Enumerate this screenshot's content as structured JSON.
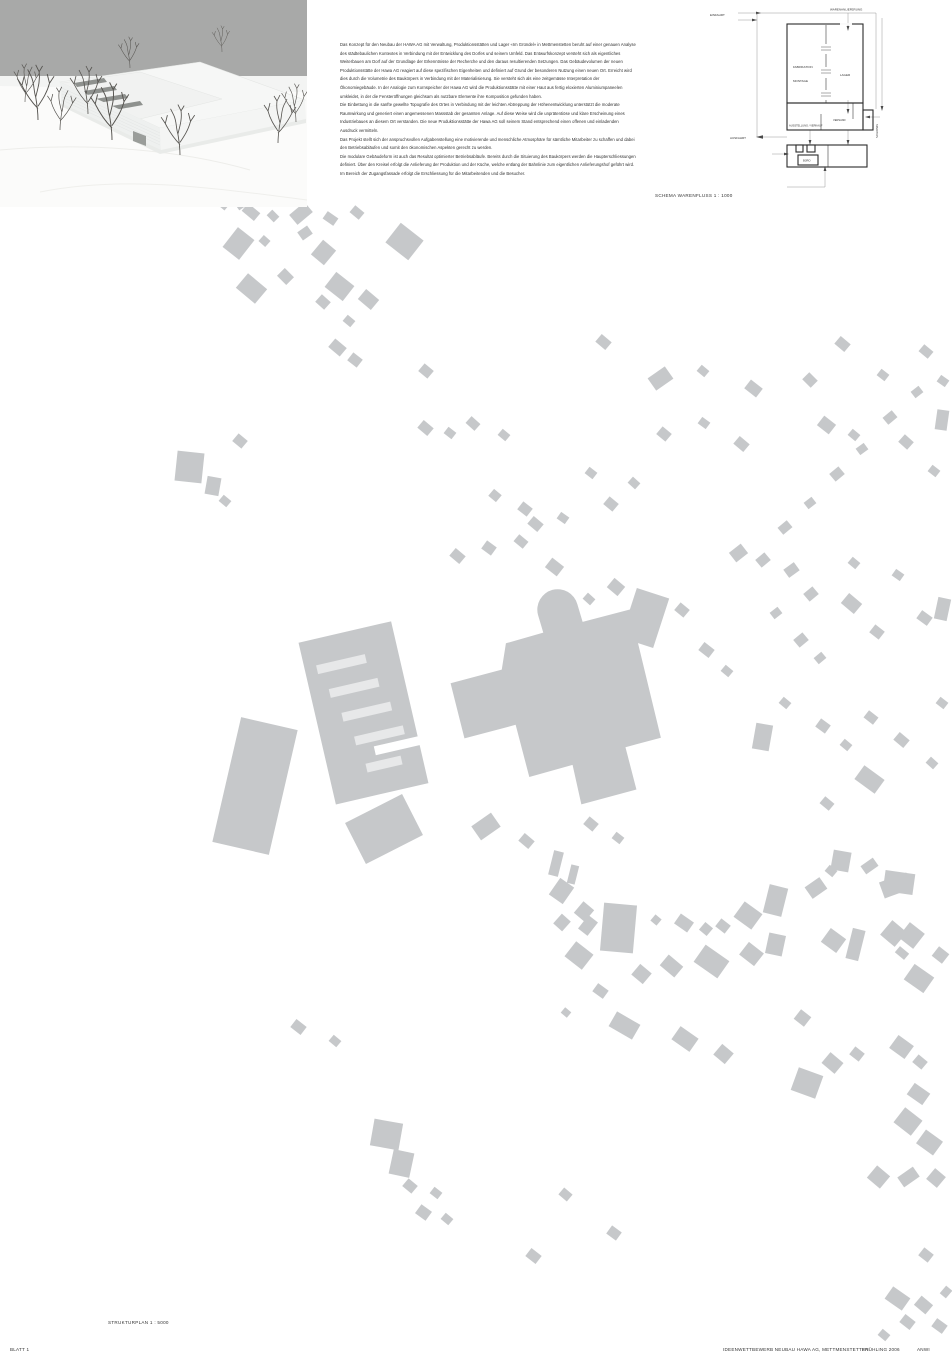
{
  "description": {
    "paragraphs": [
      "Das Konzept für den Neubau der HAWA AG mit Verwaltung, Produktionsstätten und Lager «Im Gründel» in Mettmenstetten beruht auf einer genauen Analyse des städtebaulichen Kontextes in Verbindung mit der Entwicklung des Dorfes und seinem Umfeld. Das Entwurfskonzept versteht sich als eigentliches Weiterbauen am Dorf auf der Grundlage der Erkenntnisse der Recherche und den daraus resultierenden Setzungen. Das Gebäudevolumen der neuen Produktionsstätte der Hawa AG reagiert auf diese spezifischen Eigenheiten und definiert auf Grund der besonderen Nutzung einen neuen Ort. Erreicht wird dies durch die Volumetrie des Baukörpers in Verbindung mit der Materialisierung. Sie versteht sich als eine zeitgemässe Interpretation der Ökonomiegebäude. In der Analogie zum Kornspeicher der Hawa AG wird die Produktionsstätte mit einer Haut aus fertig eloxierten Aluminiumpaneelen umkleidet, in der die Fensteröffnungen gleichsam als nutzbare Elemente ihre Komposition gefunden haben.",
      "Die Einbettung in die sanfte gewellte Topografie des Ortes in Verbindung mit der leichten Abtreppung der Höhenentwicklung unterstützt die moderate Raumwirkung und generiert einen angemessenen Massstab der gesamten Anlage. Auf diese Weise wird die unprätentiöse und klare Erscheinung eines Industriebaues an diesem Ort verstanden. Die neue Produktionsstätte der Hawa AG soll seinem Stand entsprechend einen offenen und einladenden Ausdruck vermitteln.",
      "Das Projekt stellt sich der anspruchsvollen Aufgabenstellung eine motivierende und menschliche Atmosphäre für sämtliche Mitarbeiter zu schaffen und dabei den Betriebsabläufen und somit den ökonomischen Aspekten gerecht zu werden.",
      "Die modulare Gebäudeform ist auch das Resultat optimierter Betriebsabläufe. Bereits durch die Situierung des Baukörpers werden die Haupterschliessungen definiert. Über den Kreisel erfolgt die Anlieferung der Produktion und der Küche, welche entlang der Bahnlinie zum eigentlichen Anlieferungshof geführt wird. Im Bereich der Zugangsfassade erfolgt die Erschliessung für die Mitarbeitenden und die Besucher."
    ]
  },
  "schema": {
    "caption": "SCHEMA WARENFLUSS    1 : 1000",
    "labels": {
      "einfahrt": "EINFAHRT",
      "warenanlieferung": "WARENANLIEFERUNG",
      "fabrikation": "FABRIKATION",
      "montage": "MONTAGE",
      "lager": "LAGER",
      "ausstellung": "AUSSTELLUNG / VERKAUF",
      "versand": "VERSAND",
      "spedition": "SPEDITION",
      "ausfahrt": "AUSFAHRT",
      "buero": "BÜRO"
    }
  },
  "site_plan": {
    "caption": "STRUKTURPLAN   1 : 5000",
    "building_color": "#c6c8ca",
    "buildings": [
      [
        215,
        198,
        14,
        9,
        40
      ],
      [
        236,
        200,
        11,
        8,
        -35
      ],
      [
        243,
        207,
        16,
        10,
        40
      ],
      [
        268,
        212,
        10,
        8,
        45
      ],
      [
        291,
        207,
        20,
        13,
        -40
      ],
      [
        324,
        214,
        13,
        9,
        35
      ],
      [
        351,
        208,
        12,
        9,
        40
      ],
      [
        228,
        231,
        21,
        25,
        38
      ],
      [
        260,
        237,
        9,
        8,
        42
      ],
      [
        299,
        228,
        12,
        10,
        -35
      ],
      [
        315,
        243,
        17,
        19,
        40
      ],
      [
        390,
        229,
        29,
        25,
        38
      ],
      [
        239,
        279,
        25,
        19,
        40
      ],
      [
        279,
        271,
        13,
        11,
        45
      ],
      [
        328,
        277,
        23,
        19,
        38
      ],
      [
        317,
        297,
        12,
        10,
        42
      ],
      [
        360,
        293,
        17,
        13,
        40
      ],
      [
        344,
        317,
        10,
        8,
        40
      ],
      [
        330,
        342,
        15,
        11,
        40
      ],
      [
        349,
        355,
        12,
        10,
        38
      ],
      [
        420,
        366,
        12,
        10,
        40
      ],
      [
        597,
        337,
        13,
        10,
        40
      ],
      [
        650,
        371,
        21,
        15,
        -35
      ],
      [
        698,
        367,
        10,
        8,
        40
      ],
      [
        746,
        383,
        15,
        11,
        38
      ],
      [
        804,
        375,
        12,
        10,
        45
      ],
      [
        836,
        339,
        13,
        10,
        40
      ],
      [
        878,
        371,
        10,
        8,
        38
      ],
      [
        920,
        347,
        12,
        9,
        40
      ],
      [
        938,
        377,
        10,
        8,
        35
      ],
      [
        936,
        410,
        12,
        20,
        8
      ],
      [
        176,
        452,
        27,
        30,
        6
      ],
      [
        206,
        477,
        14,
        18,
        10
      ],
      [
        234,
        436,
        12,
        10,
        40
      ],
      [
        220,
        497,
        10,
        8,
        40
      ],
      [
        419,
        423,
        13,
        10,
        40
      ],
      [
        445,
        429,
        10,
        8,
        38
      ],
      [
        467,
        419,
        12,
        9,
        42
      ],
      [
        499,
        431,
        10,
        8,
        40
      ],
      [
        490,
        491,
        10,
        9,
        40
      ],
      [
        519,
        504,
        12,
        10,
        38
      ],
      [
        529,
        519,
        13,
        10,
        40
      ],
      [
        558,
        514,
        10,
        8,
        35
      ],
      [
        586,
        469,
        10,
        8,
        38
      ],
      [
        605,
        499,
        12,
        10,
        40
      ],
      [
        629,
        479,
        10,
        8,
        42
      ],
      [
        658,
        429,
        12,
        10,
        40
      ],
      [
        699,
        419,
        10,
        8,
        36
      ],
      [
        735,
        439,
        13,
        10,
        40
      ],
      [
        819,
        419,
        15,
        12,
        38
      ],
      [
        849,
        431,
        10,
        8,
        40
      ],
      [
        900,
        437,
        12,
        10,
        42
      ],
      [
        929,
        467,
        10,
        8,
        38
      ],
      [
        912,
        388,
        10,
        8,
        -38
      ],
      [
        884,
        413,
        12,
        9,
        -40
      ],
      [
        857,
        445,
        10,
        8,
        -36
      ],
      [
        831,
        469,
        12,
        10,
        -40
      ],
      [
        805,
        499,
        10,
        8,
        -38
      ],
      [
        779,
        523,
        12,
        9,
        -40
      ],
      [
        451,
        551,
        13,
        10,
        40
      ],
      [
        483,
        543,
        12,
        10,
        36
      ],
      [
        515,
        537,
        12,
        9,
        40
      ],
      [
        547,
        561,
        15,
        12,
        38
      ],
      [
        584,
        595,
        10,
        8,
        42
      ],
      [
        609,
        581,
        14,
        12,
        40
      ],
      [
        628,
        592,
        34,
        52,
        18
      ],
      [
        676,
        605,
        12,
        10,
        40
      ],
      [
        700,
        645,
        13,
        10,
        38
      ],
      [
        722,
        667,
        10,
        8,
        40
      ],
      [
        731,
        547,
        15,
        12,
        -38
      ],
      [
        757,
        555,
        12,
        10,
        -40
      ],
      [
        785,
        565,
        13,
        10,
        -36
      ],
      [
        805,
        589,
        12,
        10,
        -40
      ],
      [
        771,
        609,
        10,
        8,
        -38
      ],
      [
        795,
        635,
        12,
        10,
        -40
      ],
      [
        815,
        654,
        10,
        8,
        -40
      ],
      [
        843,
        597,
        17,
        13,
        40
      ],
      [
        871,
        627,
        12,
        10,
        38
      ],
      [
        918,
        613,
        13,
        10,
        36
      ],
      [
        849,
        559,
        10,
        8,
        40
      ],
      [
        893,
        571,
        10,
        8,
        35
      ],
      [
        936,
        598,
        13,
        22,
        12
      ],
      [
        226,
        722,
        58,
        128,
        13
      ],
      [
        352,
        806,
        64,
        46,
        -27
      ],
      [
        754,
        724,
        17,
        26,
        10
      ],
      [
        780,
        699,
        10,
        8,
        40
      ],
      [
        817,
        721,
        12,
        10,
        36
      ],
      [
        841,
        741,
        10,
        8,
        40
      ],
      [
        865,
        713,
        12,
        9,
        38
      ],
      [
        895,
        735,
        13,
        10,
        40
      ],
      [
        927,
        759,
        10,
        8,
        42
      ],
      [
        937,
        699,
        10,
        8,
        38
      ],
      [
        857,
        771,
        25,
        17,
        36
      ],
      [
        821,
        799,
        12,
        9,
        40
      ],
      [
        884,
        872,
        30,
        21,
        8
      ],
      [
        474,
        818,
        24,
        17,
        -35
      ],
      [
        520,
        836,
        13,
        10,
        40
      ],
      [
        551,
        851,
        10,
        25,
        14
      ],
      [
        569,
        865,
        8,
        19,
        14
      ],
      [
        585,
        819,
        12,
        10,
        40
      ],
      [
        613,
        834,
        10,
        8,
        38
      ],
      [
        553,
        881,
        17,
        20,
        35
      ],
      [
        577,
        904,
        14,
        15,
        40
      ],
      [
        556,
        916,
        12,
        13,
        42
      ],
      [
        582,
        917,
        12,
        17,
        38
      ],
      [
        602,
        904,
        33,
        48,
        5
      ],
      [
        568,
        946,
        22,
        19,
        38
      ],
      [
        634,
        967,
        15,
        14,
        40
      ],
      [
        652,
        916,
        8,
        8,
        40
      ],
      [
        676,
        917,
        16,
        12,
        35
      ],
      [
        701,
        924,
        10,
        10,
        40
      ],
      [
        717,
        921,
        12,
        10,
        38
      ],
      [
        737,
        906,
        22,
        19,
        36
      ],
      [
        766,
        886,
        19,
        29,
        14
      ],
      [
        807,
        881,
        18,
        14,
        -35
      ],
      [
        832,
        851,
        18,
        20,
        10
      ],
      [
        862,
        861,
        15,
        10,
        -35
      ],
      [
        881,
        877,
        29,
        17,
        -20
      ],
      [
        826,
        867,
        10,
        8,
        40
      ],
      [
        697,
        951,
        29,
        21,
        35
      ],
      [
        742,
        946,
        19,
        16,
        38
      ],
      [
        767,
        934,
        17,
        21,
        12
      ],
      [
        824,
        932,
        19,
        17,
        36
      ],
      [
        849,
        929,
        13,
        31,
        14
      ],
      [
        884,
        924,
        19,
        19,
        40
      ],
      [
        902,
        926,
        19,
        19,
        38
      ],
      [
        907,
        969,
        24,
        19,
        35
      ],
      [
        896,
        949,
        12,
        8,
        40
      ],
      [
        934,
        949,
        13,
        12,
        38
      ],
      [
        662,
        959,
        19,
        14,
        40
      ],
      [
        594,
        986,
        13,
        10,
        36
      ],
      [
        562,
        1009,
        8,
        7,
        40
      ],
      [
        611,
        1017,
        27,
        17,
        30
      ],
      [
        674,
        1031,
        22,
        16,
        35
      ],
      [
        716,
        1047,
        15,
        14,
        40
      ],
      [
        796,
        1012,
        13,
        12,
        38
      ],
      [
        824,
        1056,
        17,
        14,
        40
      ],
      [
        851,
        1049,
        12,
        10,
        38
      ],
      [
        892,
        1039,
        19,
        16,
        36
      ],
      [
        914,
        1057,
        12,
        10,
        40
      ],
      [
        794,
        1071,
        26,
        24,
        20
      ],
      [
        909,
        1087,
        19,
        14,
        35
      ],
      [
        897,
        1112,
        22,
        19,
        38
      ],
      [
        919,
        1134,
        21,
        17,
        36
      ],
      [
        870,
        1169,
        17,
        16,
        40
      ],
      [
        899,
        1171,
        19,
        12,
        -35
      ],
      [
        929,
        1171,
        14,
        14,
        40
      ],
      [
        292,
        1022,
        13,
        10,
        38
      ],
      [
        330,
        1037,
        10,
        8,
        40
      ],
      [
        372,
        1121,
        29,
        27,
        10
      ],
      [
        391,
        1151,
        21,
        25,
        12
      ],
      [
        404,
        1181,
        12,
        10,
        40
      ],
      [
        431,
        1189,
        10,
        8,
        38
      ],
      [
        417,
        1207,
        13,
        11,
        36
      ],
      [
        442,
        1215,
        10,
        8,
        40
      ],
      [
        527,
        1251,
        13,
        10,
        38
      ],
      [
        560,
        1190,
        11,
        9,
        40
      ],
      [
        608,
        1228,
        12,
        10,
        36
      ],
      [
        887,
        1291,
        21,
        15,
        35
      ],
      [
        916,
        1299,
        15,
        12,
        40
      ],
      [
        901,
        1317,
        13,
        10,
        38
      ],
      [
        933,
        1321,
        13,
        10,
        36
      ],
      [
        879,
        1331,
        10,
        8,
        40
      ],
      [
        942,
        1287,
        8,
        10,
        40
      ],
      [
        920,
        1250,
        12,
        10,
        38
      ]
    ]
  },
  "photo": {
    "sky_color": "#a8a9a8",
    "ground_color": "#fbfbfa",
    "slit_color": "#8e918e",
    "tree_color": "#55534f"
  },
  "footer": {
    "blatt": "BLATT 1",
    "project": "IDEENWETTBEWERB NEUBAU HAWA AG, METTMENSTETTEN",
    "date": "FRÜHLING 2006",
    "code": "ANWI"
  }
}
